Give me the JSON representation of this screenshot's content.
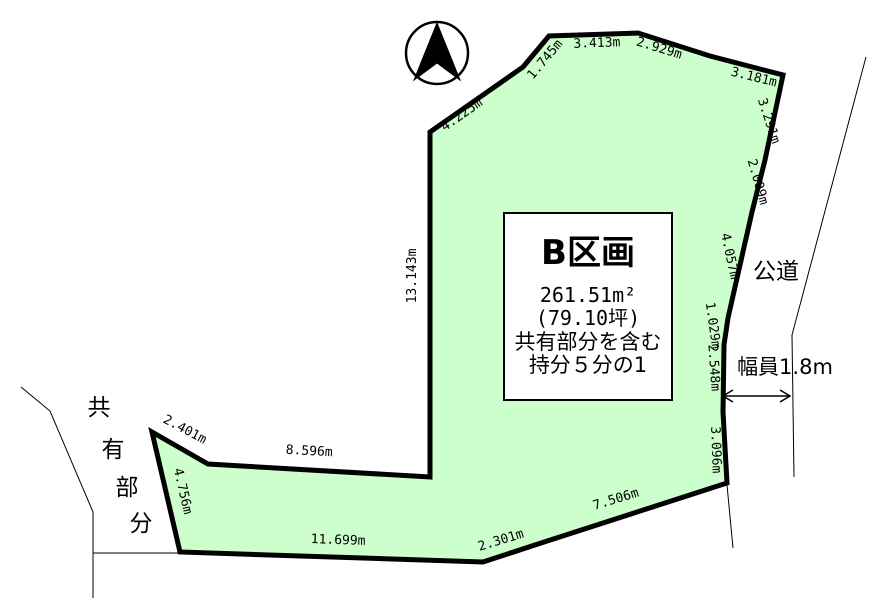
{
  "parcel_box": {
    "title": "B区画",
    "area_m2": "261.51m²",
    "area_tsubo": "(79.10坪)",
    "note_line1": "共有部分を含む",
    "note_line2": "持分５分の1"
  },
  "road": {
    "label": "公道",
    "width_label": "幅員1.8m"
  },
  "shared_area": {
    "label": "共有部分",
    "chars": [
      "共",
      "有",
      "部",
      "分"
    ]
  },
  "measurements": [
    {
      "side": "upper-left-diagonal",
      "text": "4.225m"
    },
    {
      "side": "upper-left-short",
      "text": "1.745m"
    },
    {
      "side": "top",
      "text": "3.413m"
    },
    {
      "side": "top-right-1",
      "text": "2.929m"
    },
    {
      "side": "top-right-2",
      "text": "3.181m"
    },
    {
      "side": "right-1",
      "text": "3.291m"
    },
    {
      "side": "right-2",
      "text": "2.009m"
    },
    {
      "side": "right-3",
      "text": "4.057m"
    },
    {
      "side": "right-4",
      "text": "1.029m"
    },
    {
      "side": "right-5",
      "text": "2.548m"
    },
    {
      "side": "right-6",
      "text": "3.096m"
    },
    {
      "side": "bottom-right-diagonal",
      "text": "7.506m"
    },
    {
      "side": "bottom-right-short",
      "text": "2.301m"
    },
    {
      "side": "bottom",
      "text": "11.699m"
    },
    {
      "side": "notch-left",
      "text": "4.756m"
    },
    {
      "side": "notch-top-short",
      "text": "2.401m"
    },
    {
      "side": "notch-top-long",
      "text": "8.596m"
    },
    {
      "side": "left-vertical",
      "text": "13.143m"
    }
  ],
  "colors": {
    "parcel_fill": "#ccffcc",
    "outline": "#000000",
    "background": "#ffffff"
  }
}
